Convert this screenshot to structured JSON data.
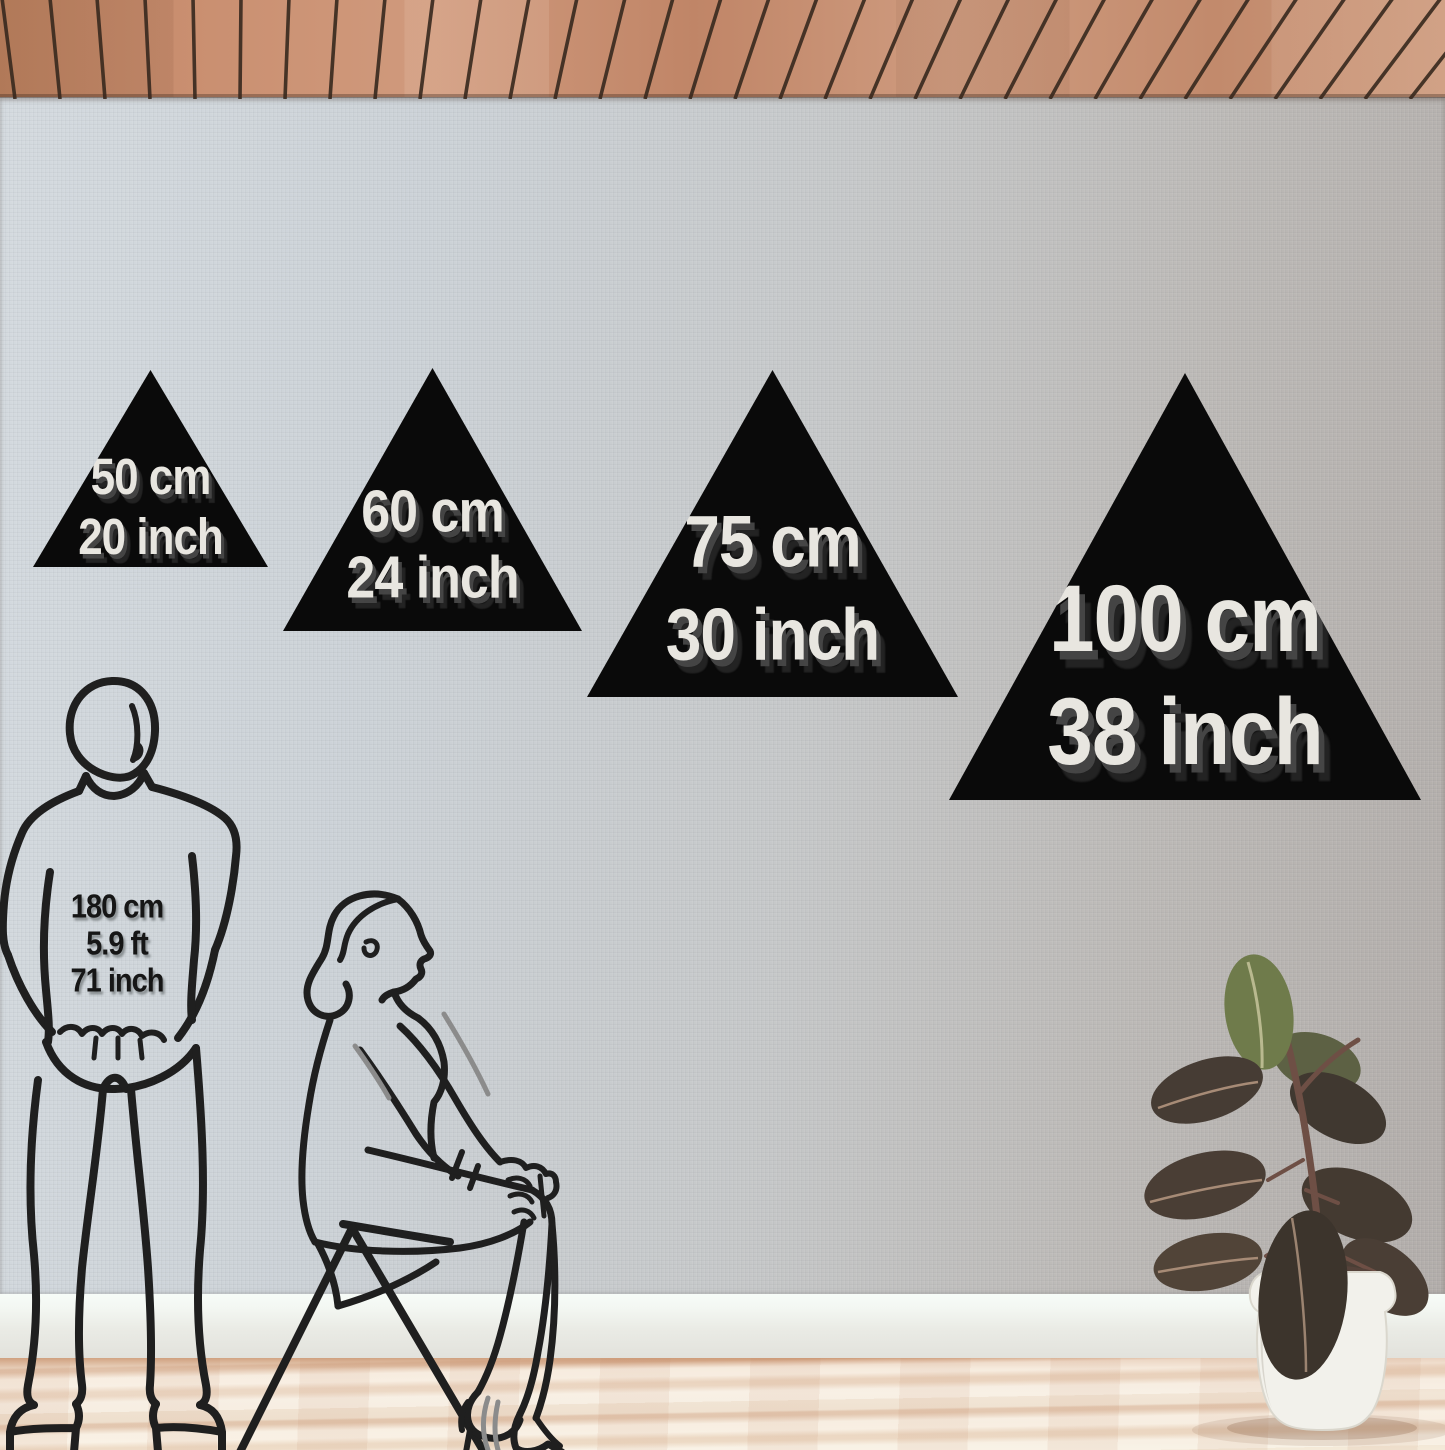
{
  "triangle_sizes": [
    {
      "id": "50cm",
      "label_cm": "50 cm",
      "label_inch": "20 inch"
    },
    {
      "id": "60cm",
      "label_cm": "60 cm",
      "label_inch": "24 inch"
    },
    {
      "id": "75cm",
      "label_cm": "75 cm",
      "label_inch": "30 inch"
    },
    {
      "id": "100cm",
      "label_cm": "100 cm",
      "label_inch": "38 inch"
    }
  ],
  "person_reference": {
    "height_cm": "180 cm",
    "height_ft": "5.9 ft",
    "height_inch": "71 inch"
  },
  "scene_icons": {
    "ceiling": "wood-slat-ceiling",
    "wall": "linen-texture-wall",
    "man": "standing-man-line-art",
    "woman": "sitting-woman-line-art",
    "stool": "stool-line-art",
    "plant": "potted-rubber-plant"
  },
  "colors": {
    "triangle_fill": "#0a0a0a",
    "triangle_label": "#e8e6e0",
    "label_shadow": "#4a4a4a",
    "line_art": "#1f1f1f",
    "wall_left": "#d4dadf",
    "wall_right": "#b2adaa",
    "ceiling_wood": "#c8947a",
    "ceiling_groove": "#3a2a20",
    "baseboard": "#eef1ec",
    "floor_light": "#f0e3d3",
    "floor_streak": "#cfa282",
    "pot": "#f2f1eb",
    "leaf_dark": "#433930",
    "leaf_green": "#6f7b4b"
  }
}
